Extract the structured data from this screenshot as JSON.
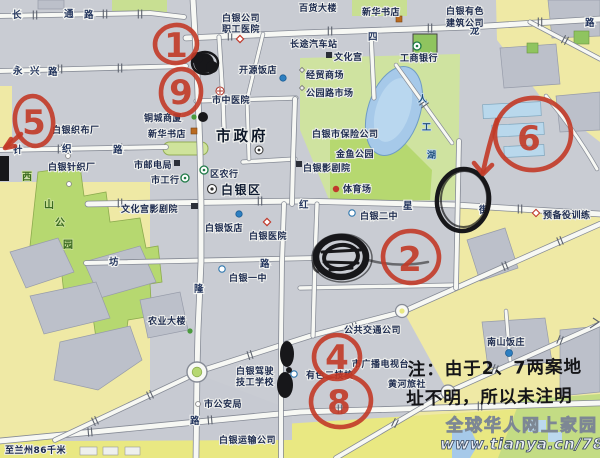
{
  "roads": {
    "changtong": [
      "长",
      "通",
      "路"
    ],
    "yongxing": [
      "永",
      "兴",
      "路"
    ],
    "silong": [
      "四",
      "龙",
      "路"
    ],
    "zhenzhi": [
      "针",
      "织",
      "路"
    ],
    "hongxing": [
      "红",
      "星",
      "街"
    ],
    "fang": "坊",
    "lu1": "路",
    "long": "隆",
    "lu2": "路"
  },
  "lake": [
    "人",
    "工",
    "湖"
  ],
  "xishan": [
    "西",
    "山",
    "公",
    "园"
  ],
  "pois": {
    "zhigong1": "白银公司",
    "zhigong2": "职工医院",
    "baihuo": "百货大楼",
    "xinhua_top": "新华书店",
    "youse1": "白银有色",
    "youse2": "建筑公司",
    "changtu": "长途汽车站",
    "wenhuagong": "文化宫",
    "jingmao": "经贸商场",
    "gongyuan_sc": "公园路市场",
    "gongshang": "工商银行",
    "kaiyuan": "开源饭店",
    "shizhong": "市中医院",
    "tongcheng": "铜城商厦",
    "xinhua2": "新华书店",
    "shizhengfu": "市政府",
    "youdian": "市邮电局",
    "shigonghang": "市工行",
    "qunonghang": "区农行",
    "baiyinqu": "白银区",
    "zhenzhichang": "白银针织厂",
    "zhibuchang": "白银织布厂",
    "wenyjy": "文化宫影剧院",
    "fandian": "白银饭店",
    "yiyuan": "白银医院",
    "erzhong": "白银二中",
    "yizhong": "白银一中",
    "tiyu": "体育场",
    "jinyu": "金鱼公园",
    "yingjy": "白银影剧院",
    "baoxian": "白银市保险公司",
    "yubeiyi": "预备役训练",
    "nanshan": "南山饭庄",
    "guangbo": "市广播电视台",
    "yousejx": "有色二技校",
    "huanghe": "黄河旅社",
    "gonggong": "公共交通公司",
    "nongye": "农业大楼",
    "jiax1": "白银驾驶",
    "jiax2": "技工学校",
    "gongan": "市公安局",
    "yunshu": "白银运输公司",
    "lanzhou": "至兰州86千米"
  },
  "annotations": {
    "n1": "1",
    "n9": "9",
    "n5": "5",
    "n6": "6",
    "n2": "2",
    "n4": "4",
    "n8": "8",
    "note1": "注：由于2、7两案地",
    "note2": "址不明，所以未注明"
  },
  "watermark": {
    "slogan": "全球华人网上家园",
    "url": "www.tianya.cn/78140653"
  },
  "colors": {
    "marker_red": "#c23a27",
    "marker_black": "#17171a",
    "area_yellow": "#efe9a5",
    "park_green": "#b6d870",
    "water_blue": "#a6c9e9"
  }
}
